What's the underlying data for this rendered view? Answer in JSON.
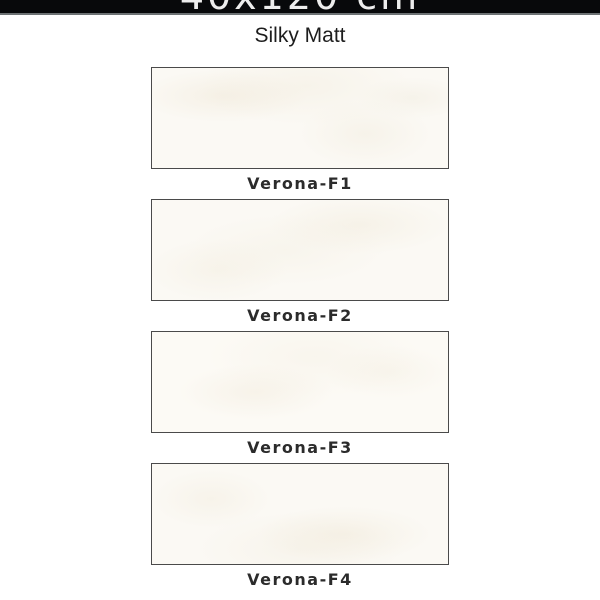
{
  "header": {
    "size_label": "40x120 cm",
    "finish_label": "Silky Matt"
  },
  "tiles": [
    {
      "name": "Verona-F1"
    },
    {
      "name": "Verona-F2"
    },
    {
      "name": "Verona-F3"
    },
    {
      "name": "Verona-F4"
    }
  ],
  "colors": {
    "header_bg": "#08090b",
    "header_text": "#ededed",
    "header_separator": "#6d7274",
    "subtitle_text": "#1d1d1d",
    "tile_fill": "#fbf9f4",
    "tile_border": "#4a4a4a",
    "label_text": "#2b2b2b",
    "page_bg": "#ffffff"
  }
}
